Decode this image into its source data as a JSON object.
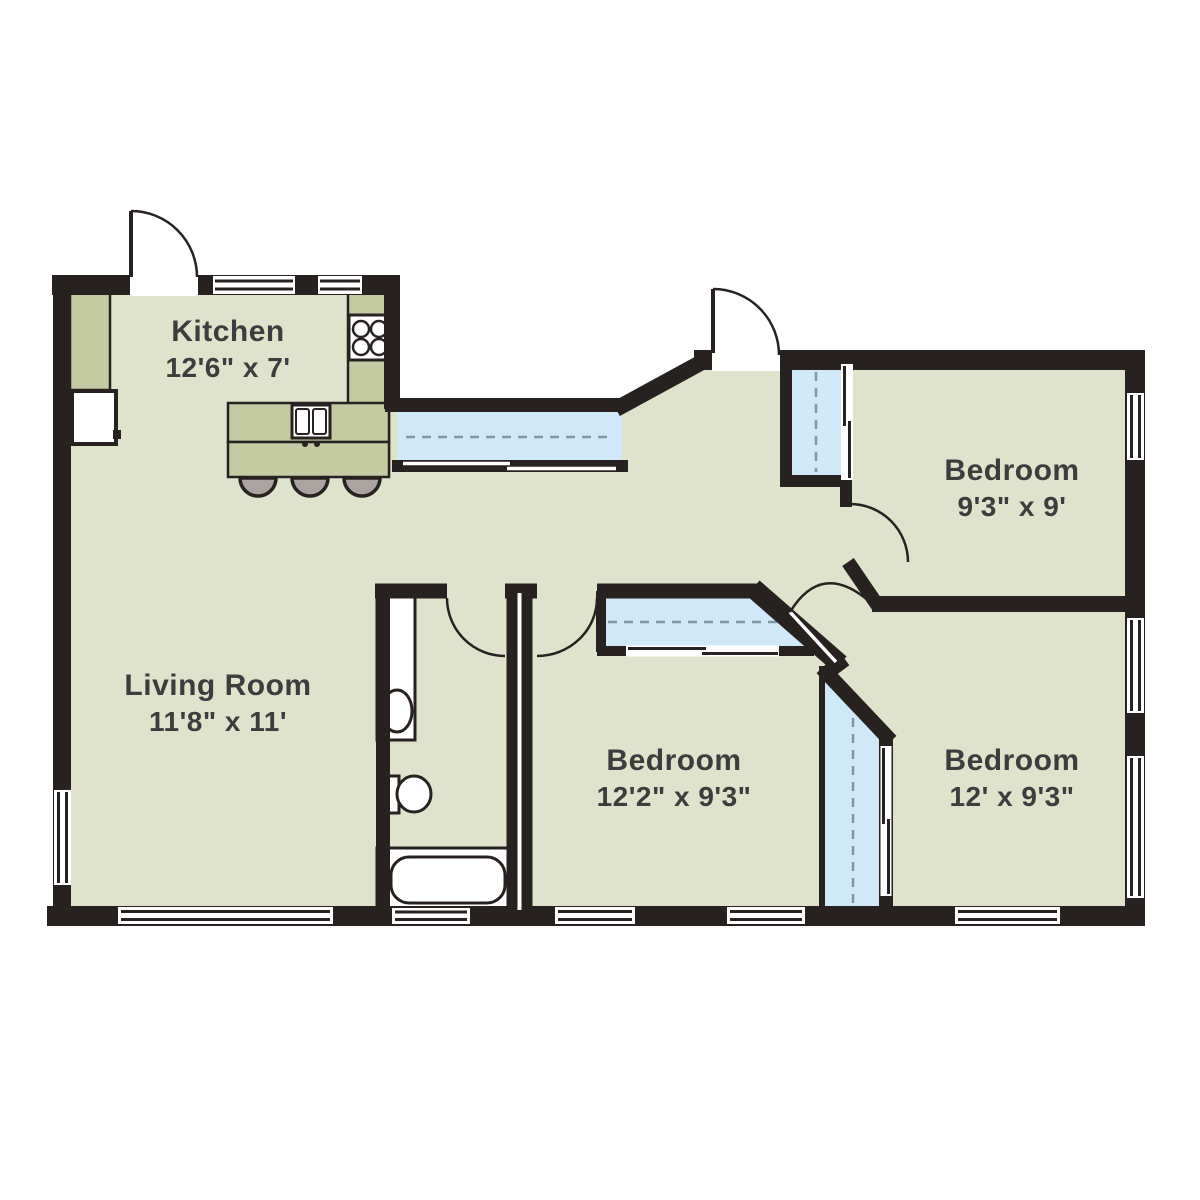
{
  "plan_title": "3-bedroom apartment floor plan",
  "rooms": [
    {
      "id": "kitchen",
      "name": "Kitchen",
      "dimensions": "12'6\" x 7'"
    },
    {
      "id": "living-room",
      "name": "Living Room",
      "dimensions": "11'8\" x 11'"
    },
    {
      "id": "bedroom-1",
      "name": "Bedroom",
      "dimensions": "9'3\" x 9'"
    },
    {
      "id": "bedroom-2",
      "name": "Bedroom",
      "dimensions": "12'2\" x 9'3\""
    },
    {
      "id": "bedroom-3",
      "name": "Bedroom",
      "dimensions": "12' x 9'3\""
    }
  ],
  "fixtures": {
    "kitchen": [
      "refrigerator-icon",
      "counter",
      "stove-icon",
      "island-sink-icon",
      "bar-stools"
    ],
    "bathroom": [
      "vanity-sink-icon",
      "toilet-icon",
      "bathtub-icon"
    ],
    "storage": [
      "hall-closet",
      "bedroom1-closet",
      "bedroom2-closet",
      "bedroom3-closet"
    ]
  },
  "colors": {
    "wall": "#272220",
    "floor": "#dfe3cb",
    "counter": "#c4cba3",
    "closet": "#cfe9f8",
    "closet_dash": "#7d98a6",
    "stool": "#aaa39f",
    "label": "#3d3d3d",
    "fixture_fill": "#ffffff"
  }
}
